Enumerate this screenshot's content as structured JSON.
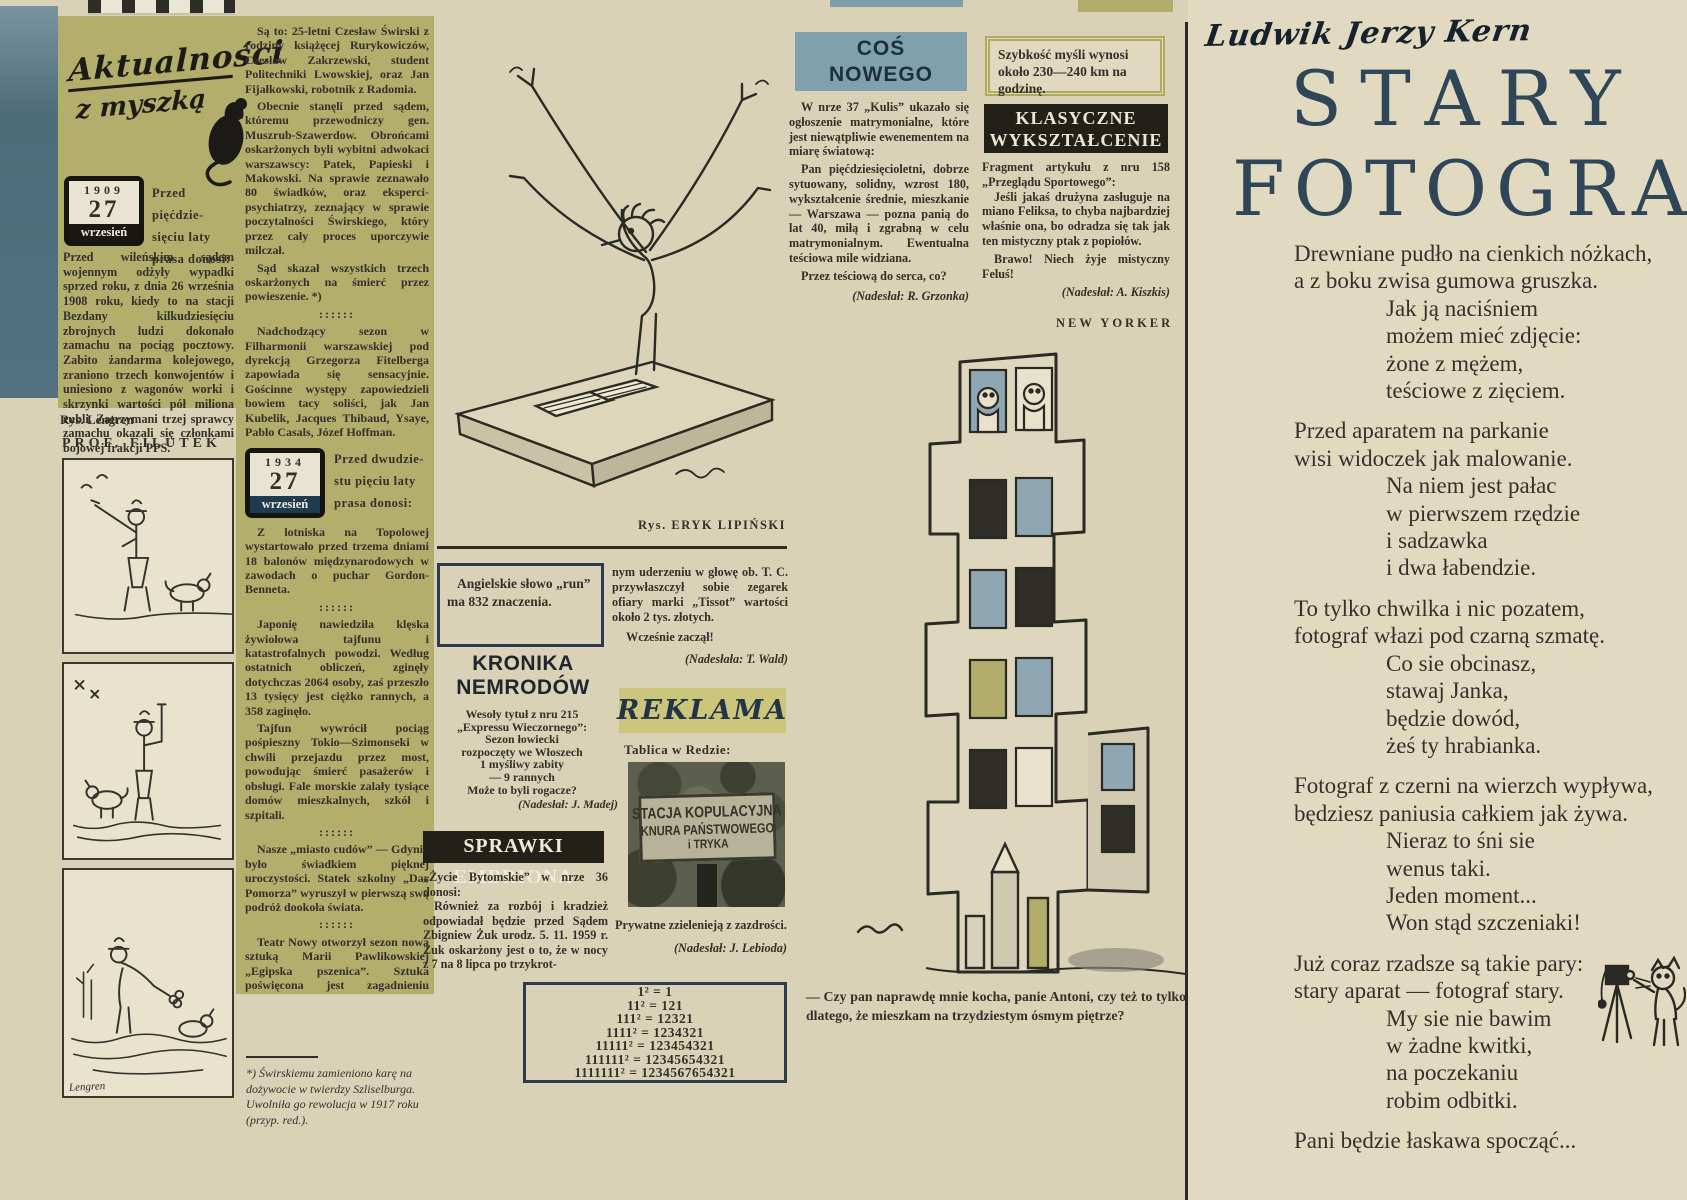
{
  "colors": {
    "paper": "#d9d2b7",
    "olive_panel": "#b4ae6c",
    "steel_blue": "#81a0ae",
    "banner_black": "#232019",
    "navy": "#2c3c50",
    "reklama_band": "#ccc67c",
    "title_blue": "#2f4659"
  },
  "masthead": {
    "line1": "Aktualności",
    "line2": "z myszką",
    "icon": "mouse-silhouette"
  },
  "stamp_1909": {
    "year": "1909",
    "day": "27",
    "month": "wrzesień"
  },
  "col1": {
    "header_lines": [
      "Przed pięćdzie-",
      "sięciu laty",
      "prasa donosi:"
    ],
    "para": "Przed wileńskim sądem wojennym odżyły wypadki sprzed roku, z dnia 26 września 1908 roku, kiedy to na stacji Bezdany kilkudziesięciu zbrojnych ludzi dokonało zamachu na pociąg pocztowy. Zabito żandarma kolejowego, zraniono trzech konwojentów i uniesiono z wagonów worki i skrzynki wartości pół miliona rubli. Zatrzymani trzej sprawcy zamachu okazali się członkami bojowej frakcji PPS.",
    "rys_credit": "Rys. Lengren",
    "comic_title": "PROF. FILUTEK",
    "comic_signature": "Lengren"
  },
  "col2": {
    "p1": "Są to: 25-letni Czesław Świrski z rodziny książęcej Rurykowiczów, Czesław Zakrzewski, student Politechniki Lwowskiej, oraz Jan Fijałkowski, robotnik z Radomia.",
    "p2": "Obecnie stanęli przed sądem, któremu przewodniczy gen. Muszrub-Szawerdow. Obrońcami oskarżonych byli wybitni adwokaci warszawscy: Patek, Papieski i Makowski. Na sprawie zeznawało 80 świadków, oraz eksperci-psychiatrzy, zeznający w sprawie poczytalności Świrskiego, który przez cały proces uporczywie milczał.",
    "p3": "Sąd skazał wszystkich trzech oskarżonych na śmierć przez powieszenie. *)",
    "divider": "::::::",
    "p4": "Nadchodzący sezon w Filharmonii warszawskiej pod dyrekcją Grzegorza Fitelberga zapowiada się sensacyjnie. Gościnne występy zapowiedzieli bowiem tacy soliści, jak Jan Kubelik, Jacques Thibaud, Ysaye, Pablo Casals, Józef Hoffman.",
    "stamp_1934": {
      "year": "1934",
      "day": "27",
      "month": "wrzesień"
    },
    "header_lines_1934": [
      "Przed dwudzie-",
      "stu pięciu laty",
      "prasa donosi:"
    ],
    "q1": "Z lotniska na Topolowej wystartowało przed trzema dniami 18 balonów międzynarodowych w zawodach o puchar Gordon-Benneta.",
    "q2": "Japonię nawiedziła klęska żywiołowa tajfunu i katastrofalnych powodzi. Według ostatnich obliczeń, zginęły dotychczas 2064 osoby, zaś przeszło 13 tysięcy jest ciężko rannych, a 358 zaginęło.",
    "q3": "Tajfun wywrócił pociąg pośpieszny Tokio—Szimonseki w chwili przejazdu przez most, powodując śmierć pasażerów i obsługi. Fale morskie zalały tysiące domów mieszkalnych, szkół i szpitali.",
    "q4": "Nasze „miasto cudów” — Gdynia było świadkiem pięknej uroczystości. Statek szkolny „Dar Pomorza” wyruszył w pierwszą swą podróż dookoła świata.",
    "q5": "Teatr Nowy otworzył sezon nową sztuką Marii Pawlikowskiej „Egipska pszenica”. Sztuka poświęcona jest zagadnieniu macierzyństwa. Reżyseruje Janusz Warnecki Grają Dulębianka, Gorczyńska, Buczyńska, Brodniewicz i Pośpiełowski.",
    "byline": "(kar. beyl.)",
    "footnote": "*) Świrskiemu zamieniono karę na dożywocie w twierdzy Szliselburga. Uwolniła go rewolucja w 1917 roku (przyp. red.)."
  },
  "conductor": {
    "caption": "Rys. ERYK LIPIŃSKI"
  },
  "run_box": {
    "text": "Angielskie słowo „run” ma 832 znaczenia."
  },
  "kronika": {
    "title_lines": [
      "KRONIKA",
      "NEMRODÓW"
    ],
    "intro_lines": [
      "Wesoły tytuł z nru 215",
      "„Expressu Wieczornego”:"
    ],
    "quote_lines": [
      "Sezon łowiecki",
      "rozpoczęty we Włoszech",
      "1 myśliwy zabity",
      "— 9 rannych"
    ],
    "question": "Może to byli rogacze?",
    "credit": "(Nadesłał: J. Madej)"
  },
  "sprawki": {
    "banner": "SPRAWKI EMBRIONA",
    "intro": "„Życie Bytomskie” w nrze 36 donosi:",
    "para1": "Również za rozbój i kradzież odpowiadał będzie przed Sądem Zbigniew Żuk urodz. 5. 11. 1959 r. Żuk oskarżony jest o to, że w nocy z 7 na 8 lipca po trzykrot-",
    "para2": "nym uderzeniu w głowę ob. T. C. przywłaszczył sobie zegarek ofiary marki „Tissot” wartości około 2 tys. złotych.",
    "exclaim": "Wcześnie zaczął!",
    "credit": "(Nadesłała: T. Wald)"
  },
  "reklama": {
    "title": "REKLAMA",
    "intro": "Tablica w Redzie:",
    "sign_lines": [
      "STACJA KOPULACYJNA",
      "KNURA PAŃSTWOWEGO",
      "i TRYKA"
    ],
    "para": "Prywatne zzielenieją z zazdrości.",
    "credit": "(Nadesłał: J. Lebioda)"
  },
  "math_box": {
    "rows": [
      "1² = 1",
      "11² = 121",
      "111² = 12321",
      "1111² = 1234321",
      "11111² = 123454321",
      "111111² = 12345654321",
      "1111111² = 1234567654321"
    ]
  },
  "cos_nowego": {
    "title_lines": [
      "COŚ",
      "NOWEGO"
    ],
    "p1": "W nrze 37 „Kulis” ukazało się ogłoszenie matrymonialne, które jest niewątpliwie ewenementem na miarę światową:",
    "p2": "Pan pięćdziesięcioletni, dobrze sytuowany, solidny, wzrost 180, wykształcenie średnie, mieszkanie — Warszawa — pozna panią do lat 40, miłą i zgrabną w celu matrymonialnym. Ewentualna teściowa mile widziana.",
    "p3": "Przez teściową do serca, co?",
    "credit": "(Nadesłał: R. Grzonka)"
  },
  "szybkosc": {
    "text": "Szybkość myśli wynosi około 230—240 km na godzinę."
  },
  "klasyczne": {
    "banner_lines": [
      "KLASYCZNE",
      "WYKSZTAŁCENIE"
    ],
    "intro": "Fragment artykułu z nru 158 „Przeglądu Sportowego”:",
    "p1": "Jeśli jakaś drużyna zasługuje na miano Feliksa, to chyba najbardziej właśnie ona, bo odradza się tak jak ten mistyczny ptak z popiołów.",
    "p2": "Brawo! Niech żyje mistyczny Feluś!",
    "credit": "(Nadesłał: A. Kiszkis)"
  },
  "new_yorker": {
    "label": "NEW YORKER",
    "caption": "— Czy pan naprawdę mnie kocha, panie Antoni, czy też to tylko dlatego, że mieszkam na trzydziestym ósmym piętrze?"
  },
  "poem": {
    "author": "Ludwik Jerzy Kern",
    "title_lines": [
      "STARY",
      "FOTOGRAF"
    ],
    "stanzas": [
      {
        "lead": [
          "Drewniane pudło na cienkich nóżkach,",
          "a z boku zwisa gumowa gruszka."
        ],
        "ind": [
          "Jak ją naciśniem",
          "możem mieć zdjęcie:",
          "żone z mężem,",
          "teściowe z zięciem."
        ]
      },
      {
        "lead": [
          "Przed aparatem na parkanie",
          "wisi widoczek jak malowanie."
        ],
        "ind": [
          "Na niem jest pałac",
          "w pierwszem rzędzie",
          "i sadzawka",
          "i dwa łabendzie."
        ]
      },
      {
        "lead": [
          "To tylko chwilka i nic pozatem,",
          "fotograf włazi pod czarną szmatę."
        ],
        "ind": [
          "Co sie obcinasz,",
          "stawaj Janka,",
          "będzie dowód,",
          "żeś ty hrabianka."
        ]
      },
      {
        "lead": [
          "Fotograf z czerni na wierzch wypływa,",
          "będziesz paniusia całkiem jak żywa."
        ],
        "ind": [
          "Nieraz to śni sie",
          "wenus taki.",
          "Jeden moment...",
          "Won stąd szczeniaki!"
        ]
      },
      {
        "lead": [
          "Już coraz rzadsze są takie pary:",
          "stary aparat — fotograf stary."
        ],
        "ind": [
          "My sie nie bawim",
          "w żadne kwitki,",
          "na poczekaniu",
          "robim odbitki."
        ]
      }
    ],
    "last_line": "Pani będzie łaskawa spocząć..."
  }
}
